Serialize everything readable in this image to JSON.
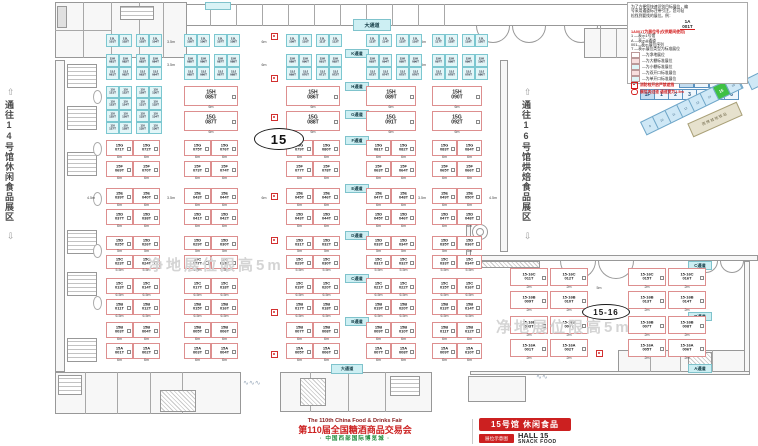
{
  "hall": {
    "big_label": "15",
    "ext_label": "15-16"
  },
  "corridors": {
    "left": "通往14号馆休闲食品展区",
    "right": "通往16号馆烘焙食品展区",
    "up_arrow": "⇧",
    "down_arrow": "⇩"
  },
  "watermark": "净地展位限高5m",
  "legend": {
    "intro": [
      "为了方便您快速识别目标展位，编",
      "号采用通道标注带引注，您可轻",
      "松找到要找的展位。例："
    ],
    "sample_top": "1A",
    "sample_bottom": "001T",
    "title": "1A001T为展位号(仅供期间使用)",
    "lines": [
      "1 —表示1号馆",
      "A —表示A通道",
      "001—表示展位序列",
      "T —表示展位类型为标准展位"
    ],
    "keys": [
      {
        "color": "#ffffff",
        "text": "—为净地展位"
      },
      {
        "color": "#f8dede",
        "text": "—为大棚标准展位"
      },
      {
        "color": "#dff5f7",
        "text": "—为小棚标准展位"
      },
      {
        "color": "#f8dede",
        "text": "—为双开口标准展位"
      },
      {
        "color": "#dff5f7",
        "text": "—为单开口标准展位"
      }
    ],
    "fire_note": "消防栓开启严禁遮挡",
    "pillar_note": "展位内过道 通道宽为1.5m"
  },
  "selector": {
    "row1": [
      "2F",
      "7",
      "8"
    ],
    "row2": [
      "1F",
      "1",
      "2",
      "3",
      "4",
      "5",
      "6"
    ]
  },
  "minimap": {
    "segments": [
      "9",
      "10",
      "11",
      "12",
      "13",
      "14",
      "15",
      "16"
    ],
    "active": "15",
    "station": "西博城地铁站"
  },
  "footer": {
    "fair_en": "The 110th China Food & Drinks Fair",
    "fair_cn": "第110届全国糖酒商品交易会",
    "venue": "· 中国西部国际博览城 ·",
    "hall_title": "15号馆 休闲食品",
    "hall_en": "HALL 15",
    "hall_sub": "SNACK FOOD",
    "badge": "展位示意图"
  },
  "aisles": [
    {
      "t": "大通道",
      "x": 353,
      "y": 19,
      "w": 36,
      "h": 10,
      "big": true
    },
    {
      "t": "K通道",
      "x": 345,
      "y": 49
    },
    {
      "t": "H通道",
      "x": 345,
      "y": 82
    },
    {
      "t": "G通道",
      "x": 345,
      "y": 110
    },
    {
      "t": "F通道",
      "x": 345,
      "y": 136
    },
    {
      "t": "E通道",
      "x": 345,
      "y": 184
    },
    {
      "t": "D通道",
      "x": 345,
      "y": 231
    },
    {
      "t": "C通道",
      "x": 345,
      "y": 274
    },
    {
      "t": "B通道",
      "x": 345,
      "y": 317
    },
    {
      "t": "大通道",
      "x": 331,
      "y": 364,
      "w": 30,
      "h": 8
    },
    {
      "t": "C通道",
      "x": 688,
      "y": 261
    },
    {
      "t": "B通道",
      "x": 688,
      "y": 312
    },
    {
      "t": "A通道",
      "x": 688,
      "y": 364
    }
  ],
  "dims": [
    {
      "t": "3.5m",
      "x": 162,
      "y": 41
    },
    {
      "t": "6m",
      "x": 255,
      "y": 41
    },
    {
      "t": "3.5m",
      "x": 413,
      "y": 41
    },
    {
      "t": "3.5m",
      "x": 162,
      "y": 64
    },
    {
      "t": "6m",
      "x": 255,
      "y": 64
    },
    {
      "t": "3.5m",
      "x": 413,
      "y": 64
    },
    {
      "t": "4.5m",
      "x": 82,
      "y": 197
    },
    {
      "t": "3.5m",
      "x": 162,
      "y": 197
    },
    {
      "t": "6m",
      "x": 255,
      "y": 197
    },
    {
      "t": "3.5m",
      "x": 413,
      "y": 197
    },
    {
      "t": "4.5m",
      "x": 484,
      "y": 197
    },
    {
      "t": "5m",
      "x": 590,
      "y": 287
    }
  ],
  "hydrants": [
    [
      271,
      33
    ],
    [
      271,
      75
    ],
    [
      271,
      114
    ],
    [
      271,
      193
    ],
    [
      271,
      237
    ],
    [
      271,
      309
    ],
    [
      271,
      351
    ],
    [
      596,
      308
    ],
    [
      596,
      350
    ]
  ],
  "layout": {
    "pinkGroups": [
      [
        106,
        54
      ],
      [
        184,
        54
      ],
      [
        286,
        54
      ],
      [
        366,
        50
      ],
      [
        432,
        50
      ]
    ],
    "cyanGroups": [
      106,
      136,
      184,
      214,
      286,
      316,
      366,
      396,
      432,
      462
    ],
    "extGroups": [
      [
        510,
        38
      ],
      [
        550,
        38
      ],
      [
        628,
        38
      ],
      [
        668,
        38
      ]
    ],
    "watermark_pos": [
      [
        148,
        254
      ],
      [
        496,
        316
      ]
    ],
    "ovals": [
      {
        "t": "15",
        "x": 254,
        "y": 128,
        "w": 48,
        "h": 20,
        "fs": 13
      },
      {
        "t": "15-16",
        "x": 582,
        "y": 304,
        "w": 46,
        "h": 14,
        "fs": 8
      }
    ]
  },
  "cyan_bands": [
    {
      "y": 34,
      "rows": [
        {
          "series": "15L",
          "nums": [
            "101T",
            "102T",
            "103T",
            "104T",
            "105T",
            "106T",
            "107T",
            "108T",
            "109T",
            "110T",
            "111T",
            "112T",
            "113T",
            "114T",
            "115T",
            "116T",
            "117T",
            "118T",
            "119T",
            "120T"
          ]
        }
      ]
    },
    {
      "y": 54,
      "rows": [
        {
          "series": "15K",
          "nums": [
            "081T",
            "082T",
            "083T",
            "084T",
            "085T",
            "086T",
            "087T",
            "088T",
            "089T",
            "090T",
            "091T",
            "092T",
            "093T",
            "094T",
            "095T",
            "096T",
            "097T",
            "098T",
            "099T",
            "100T"
          ]
        },
        {
          "series": "15J",
          "nums": [
            "061T",
            "062T",
            "063T",
            "064T",
            "065T",
            "066T",
            "067T",
            "068T",
            "069T",
            "070T",
            "071T",
            "072T",
            "073T",
            "074T",
            "075T",
            "076T",
            "077T",
            "078T",
            "079T",
            "080T"
          ]
        }
      ]
    }
  ],
  "cyan_blocks": [
    {
      "x": 106,
      "y": 86,
      "series": "15I",
      "nums": [
        "121T",
        "122T",
        "123T",
        "124T",
        "125T",
        "126T",
        "127T",
        "128T"
      ]
    },
    {
      "x": 136,
      "y": 86,
      "series": "15I",
      "nums": [
        "129T",
        "130T",
        "131T",
        "132T",
        "133T",
        "134T",
        "135T",
        "136T"
      ]
    }
  ],
  "pink_bands": [
    {
      "y": 86,
      "wide": true,
      "rowH": 20,
      "dims": [
        "6m",
        "6m"
      ],
      "rows": [
        {
          "series": "15H",
          "nums": [
            "085T",
            "086T",
            "089T",
            "090T"
          ]
        },
        {
          "series": "15G",
          "nums": [
            "087T",
            "088T",
            "091T",
            "092T"
          ]
        }
      ]
    },
    {
      "y": 140,
      "rowH": 16,
      "dims": [
        "6m",
        "6m"
      ],
      "rows": [
        {
          "series": "15G",
          "nums": [
            "071T",
            "072T",
            "075T",
            "076T",
            "079T",
            "080T",
            "081T",
            "082T",
            "083T",
            "084T"
          ]
        },
        {
          "series": "15F",
          "nums": [
            "069T",
            "070T",
            "073T",
            "074T",
            "077T",
            "078T",
            "063T",
            "064T",
            "065T",
            "066T"
          ]
        }
      ]
    },
    {
      "y": 188,
      "rowH": 16,
      "dims": [
        "6m",
        "6m"
      ],
      "rows": [
        {
          "series": "15E",
          "nums": [
            "039T",
            "040T",
            "043T",
            "044T",
            "045T",
            "046T",
            "047T",
            "048T",
            "049T",
            "050T"
          ]
        },
        {
          "series": "15D",
          "nums": [
            "037T",
            "038T",
            "041T",
            "042T",
            "043T",
            "044T",
            "045T",
            "046T",
            "047T",
            "048T"
          ]
        }
      ]
    },
    {
      "y": 236,
      "rowH": 14,
      "dims": [
        "5m",
        "5.5m"
      ],
      "rows": [
        {
          "series": "15D",
          "nums": [
            "025T",
            "026T",
            "029T",
            "030T",
            "031T",
            "032T",
            "033T",
            "034T",
            "035T",
            "036T"
          ]
        },
        {
          "series": "15C",
          "nums": [
            "023T",
            "024T",
            "027T",
            "028T",
            "029T",
            "030T",
            "031T",
            "032T",
            "033T",
            "034T"
          ]
        }
      ]
    },
    {
      "y": 278,
      "rowH": 16,
      "dims": [
        "6.5m",
        "6.5m"
      ],
      "rows": [
        {
          "series": "15C",
          "nums": [
            "013T",
            "014T",
            "017T",
            "018T",
            "019T",
            "020T",
            "021T",
            "022T",
            "015T",
            "016T"
          ]
        },
        {
          "series": "15B",
          "nums": [
            "011T",
            "012T",
            "015T",
            "016T",
            "017T",
            "018T",
            "019T",
            "020T",
            "013T",
            "014T"
          ]
        }
      ]
    },
    {
      "y": 322,
      "rowH": 16,
      "dims": [
        "6m",
        "6m"
      ],
      "rows": [
        {
          "series": "15B",
          "nums": [
            "003T",
            "004T",
            "005T",
            "006T",
            "007T",
            "008T",
            "009T",
            "010T",
            "011T",
            "012T"
          ]
        },
        {
          "series": "15A",
          "nums": [
            "001T",
            "002T",
            "003T",
            "004T",
            "005T",
            "006T",
            "007T",
            "008T",
            "009T",
            "010T"
          ]
        }
      ]
    }
  ],
  "ext_bands": [
    {
      "y": 268,
      "rowH": 18,
      "dims": [
        "2m",
        "2m"
      ],
      "rows": [
        {
          "series": "15-16C",
          "nums": [
            "011T",
            "012T",
            "015T",
            "016T"
          ]
        },
        {
          "series": "15-16B",
          "nums": [
            "009T",
            "010T",
            "013T",
            "014T"
          ]
        }
      ]
    },
    {
      "y": 316,
      "rowH": 18,
      "dims": [
        "2m",
        "2m"
      ],
      "rows": [
        {
          "series": "15-16B",
          "nums": [
            "003T",
            "004T",
            "007T",
            "008T"
          ]
        },
        {
          "series": "15-16A",
          "nums": [
            "001T",
            "002T",
            "005T",
            "006T"
          ]
        }
      ]
    }
  ]
}
